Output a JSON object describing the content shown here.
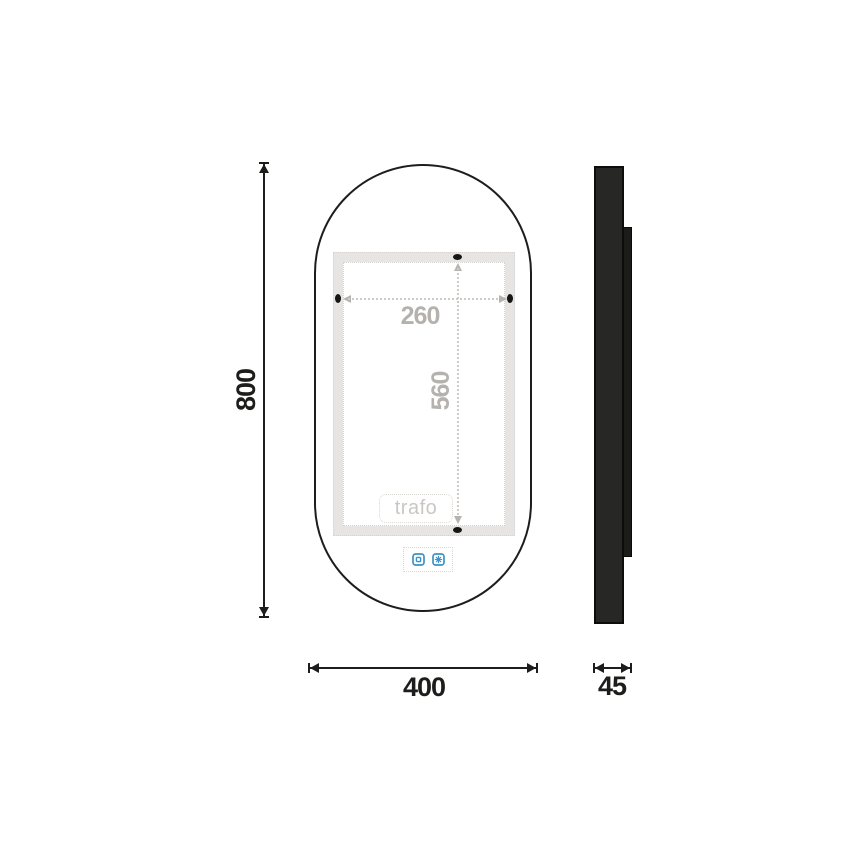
{
  "front_view": {
    "overall_height": "800",
    "overall_width": "400",
    "led_frame_width": "260",
    "led_frame_height": "560",
    "trafo_label": "trafo"
  },
  "side_view": {
    "depth": "45"
  },
  "icons": {
    "power_sensor": "light-toggle-icon",
    "defog_sensor": "defog-icon"
  },
  "colors": {
    "outline_black": "#1d1d1b",
    "dim_gray_text": "#b5b2ae",
    "led_band_gray": "#e6e5e3",
    "dotted_gray": "#d6d3cf",
    "sensor_blue": "#3b93c6",
    "background": "#ffffff"
  }
}
